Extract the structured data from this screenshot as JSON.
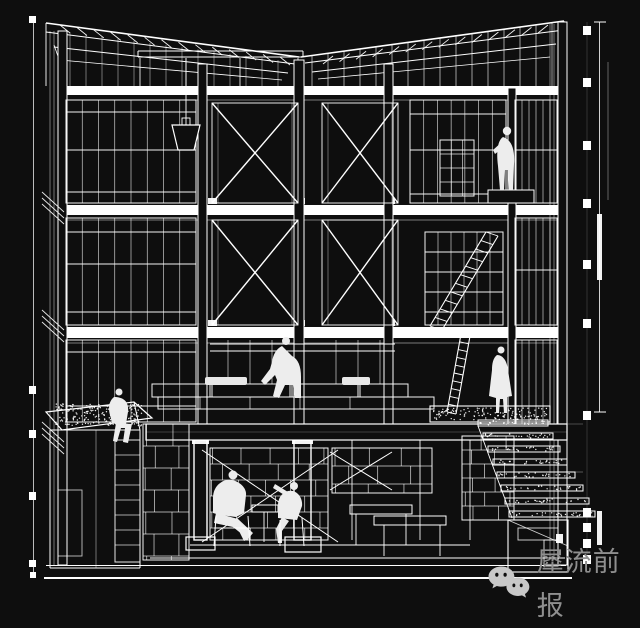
{
  "canvas": {
    "width": 640,
    "height": 599,
    "background": "#0e0e0e",
    "line_color": "#ffffff",
    "subject_kind": "wireframe-building-section"
  },
  "watermark": {
    "icon": "wechat-icon",
    "text": "犀流前报",
    "text_color": "#8f8f8f",
    "logo_color": "#c8c8c8"
  }
}
